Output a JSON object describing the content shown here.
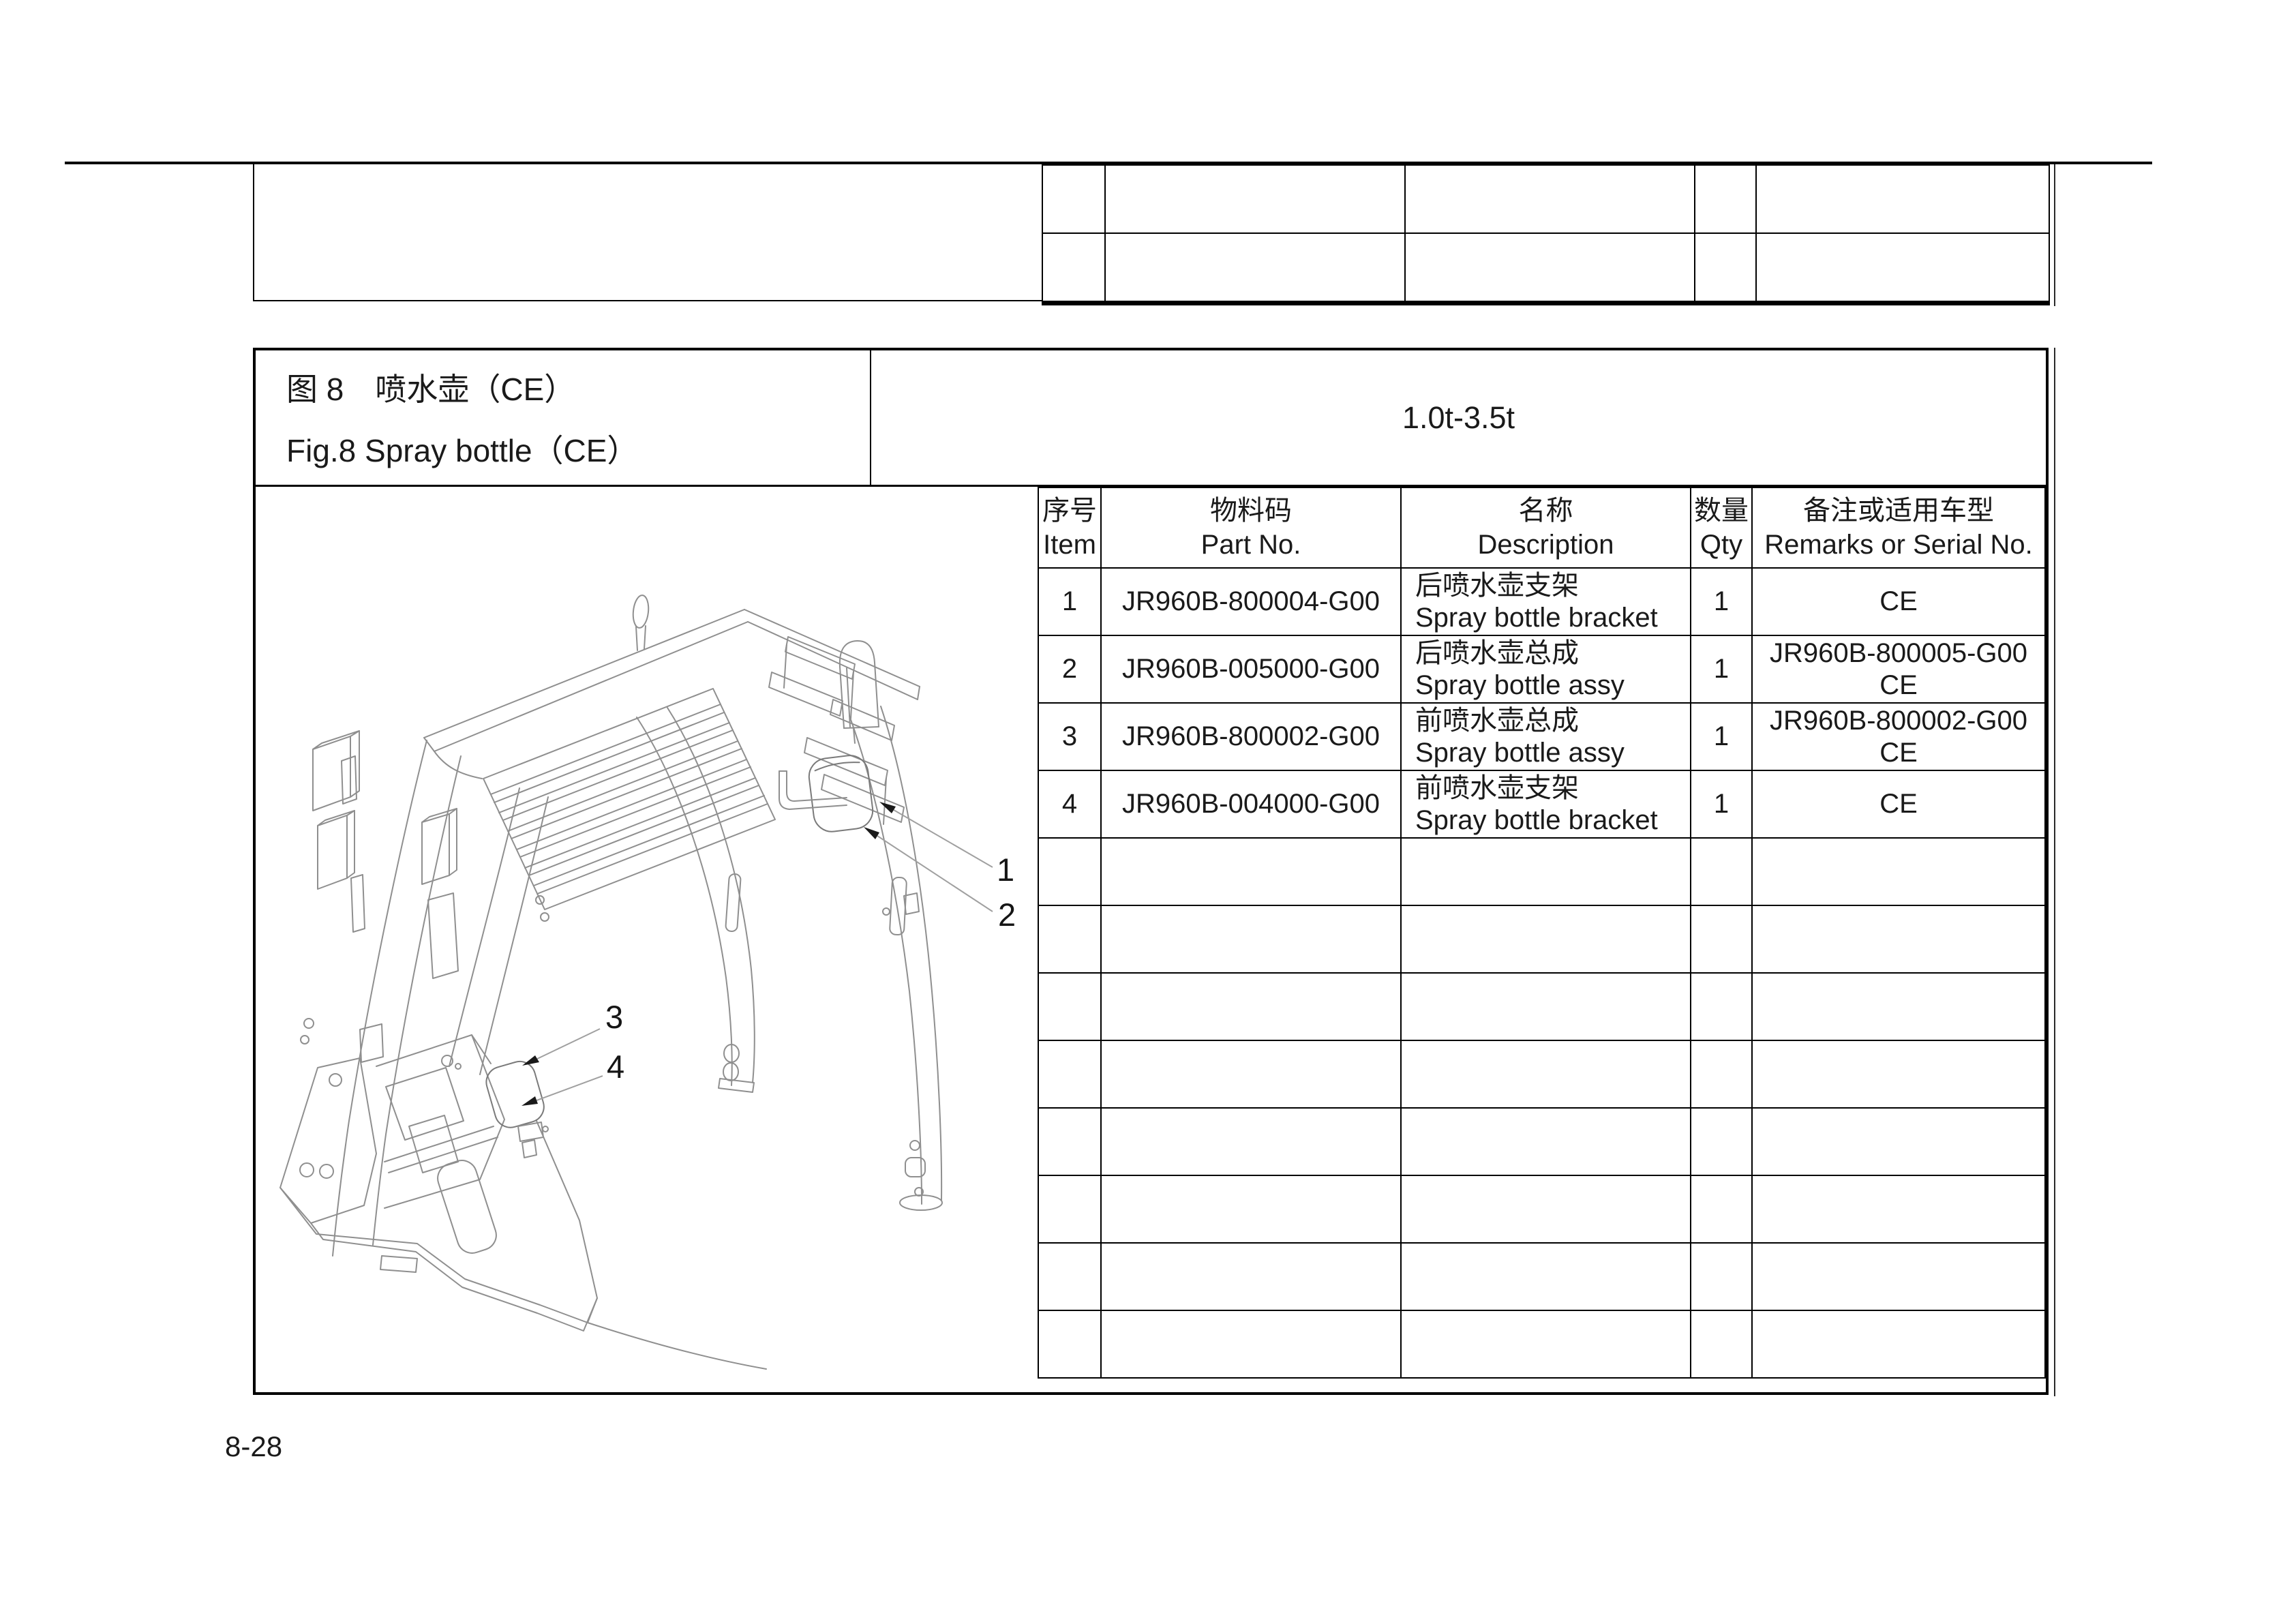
{
  "page": {
    "page_number": "8-28"
  },
  "figure_header": {
    "title_zh": "图 8　喷水壶（CE）",
    "title_en": "Fig.8  Spray bottle（CE）",
    "capacity_range": "1.0t-3.5t"
  },
  "parts_table": {
    "headers": {
      "item_zh": "序号",
      "item_en": "Item",
      "part_no_zh": "物料码",
      "part_no_en": "Part No.",
      "desc_zh": "名称",
      "desc_en": "Description",
      "qty_zh": "数量",
      "qty_en": "Qty",
      "remarks_zh": "备注或适用车型",
      "remarks_en": "Remarks or Serial No."
    },
    "rows": [
      {
        "item": "1",
        "part_no": "JR960B-800004-G00",
        "desc_zh": "后喷水壶支架",
        "desc_en": "Spray bottle bracket",
        "qty": "1",
        "remarks_line1": "CE",
        "remarks_line2": ""
      },
      {
        "item": "2",
        "part_no": "JR960B-005000-G00",
        "desc_zh": "后喷水壶总成",
        "desc_en": "Spray bottle assy",
        "qty": "1",
        "remarks_line1": "JR960B-800005-G00",
        "remarks_line2": "CE"
      },
      {
        "item": "3",
        "part_no": "JR960B-800002-G00",
        "desc_zh": "前喷水壶总成",
        "desc_en": "Spray bottle assy",
        "qty": "1",
        "remarks_line1": "JR960B-800002-G00",
        "remarks_line2": "CE"
      },
      {
        "item": "4",
        "part_no": "JR960B-004000-G00",
        "desc_zh": "前喷水壶支架",
        "desc_en": "Spray bottle bracket",
        "qty": "1",
        "remarks_line1": "CE",
        "remarks_line2": ""
      }
    ],
    "empty_body_rows": 8,
    "top_continuation_empty_rows": 2
  },
  "diagram": {
    "type": "isometric wireframe of forklift overhead guard with spray bottles",
    "callout_1": "1",
    "callout_2": "2",
    "callout_3": "3",
    "callout_4": "4"
  },
  "colors": {
    "border_black": "#000000",
    "drawing_gray": "#8f8f8f",
    "background": "#ffffff"
  }
}
